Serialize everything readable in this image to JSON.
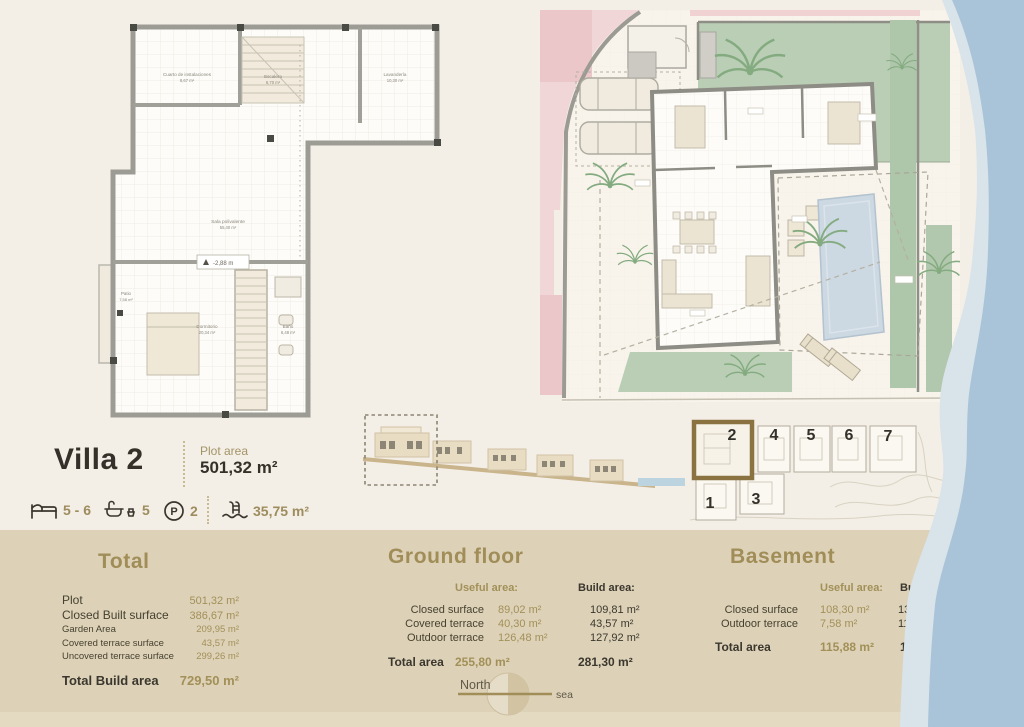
{
  "colors": {
    "accent": "#a08d58",
    "dark": "#3b372e",
    "panel_bg": "#ddd2b8",
    "page_bg": "#f4efe6",
    "sea_blue": "#a9c4d8",
    "sea_light": "#d9e3ea",
    "garden_green": "#b9ceb4",
    "road_pink": "#f1d6d7",
    "pool_blue": "#ccd8e2",
    "highlight_brown": "#8a7340"
  },
  "header": {
    "title": "Villa 2",
    "plot_area_label": "Plot area",
    "plot_area_value": "501,32 m²"
  },
  "features": {
    "beds": "5 - 6",
    "baths": "5",
    "parking_letter": "P",
    "parking": "2",
    "pool": "35,75 m²"
  },
  "basement_plan": {
    "rooms": [
      {
        "name": "Cuarto de instalaciones",
        "area": "8,67 m²"
      },
      {
        "name": "Escalera",
        "area": "6,70 m²"
      },
      {
        "name": "Lavandería",
        "area": "10,30 m²"
      },
      {
        "name": "Sala polivalente",
        "area": "55,40 m²"
      },
      {
        "name": "Patio",
        "area": "7,58 m²"
      },
      {
        "name": "Dormitorio",
        "area": "20,34 m²"
      },
      {
        "name": "Baño",
        "area": "6,48 m²"
      }
    ],
    "level_marker": "-2,88 m"
  },
  "site_plan": {
    "numbers": [
      "2",
      "4",
      "5",
      "6",
      "7",
      "1",
      "3"
    ],
    "highlighted": "2"
  },
  "compass": {
    "north_label": "North",
    "sea_label": "sea"
  },
  "tables": {
    "total": {
      "title": "Total",
      "rows": [
        {
          "label": "Plot",
          "value": "501,32 m²"
        },
        {
          "label": "Closed Built surface",
          "value": "386,67 m²"
        },
        {
          "label": "Garden Area",
          "value": "209,95 m²"
        },
        {
          "label": "Covered terrace surface",
          "value": "43,57 m²"
        },
        {
          "label": "Uncovered terrace surface",
          "value": "299,26 m²"
        }
      ],
      "total_label": "Total Build area",
      "total_value": "729,50 m²"
    },
    "ground_floor": {
      "title": "Ground floor",
      "useful_header": "Useful area:",
      "build_header": "Build area:",
      "rows": [
        {
          "label": "Closed surface",
          "useful": "89,02 m²",
          "build": "109,81 m²"
        },
        {
          "label": "Covered terrace",
          "useful": "40,30 m²",
          "build": "43,57 m²"
        },
        {
          "label": "Outdoor terrace",
          "useful": "126,48 m²",
          "build": "127,92 m²"
        }
      ],
      "total_label": "Total area",
      "total_useful": "255,80 m²",
      "total_build": "281,30 m²"
    },
    "basement": {
      "title": "Basement",
      "useful_header": "Useful area:",
      "build_header": "Build area:",
      "rows": [
        {
          "label": "Closed surface",
          "useful": "108,30 m²",
          "build": "135,61 m²"
        },
        {
          "label": "Outdoor terrace",
          "useful": "7,58 m²",
          "build": "11,08 m²"
        }
      ],
      "total_label": "Total area",
      "total_useful": "115,88 m²",
      "total_build": "146,69 m²"
    }
  }
}
